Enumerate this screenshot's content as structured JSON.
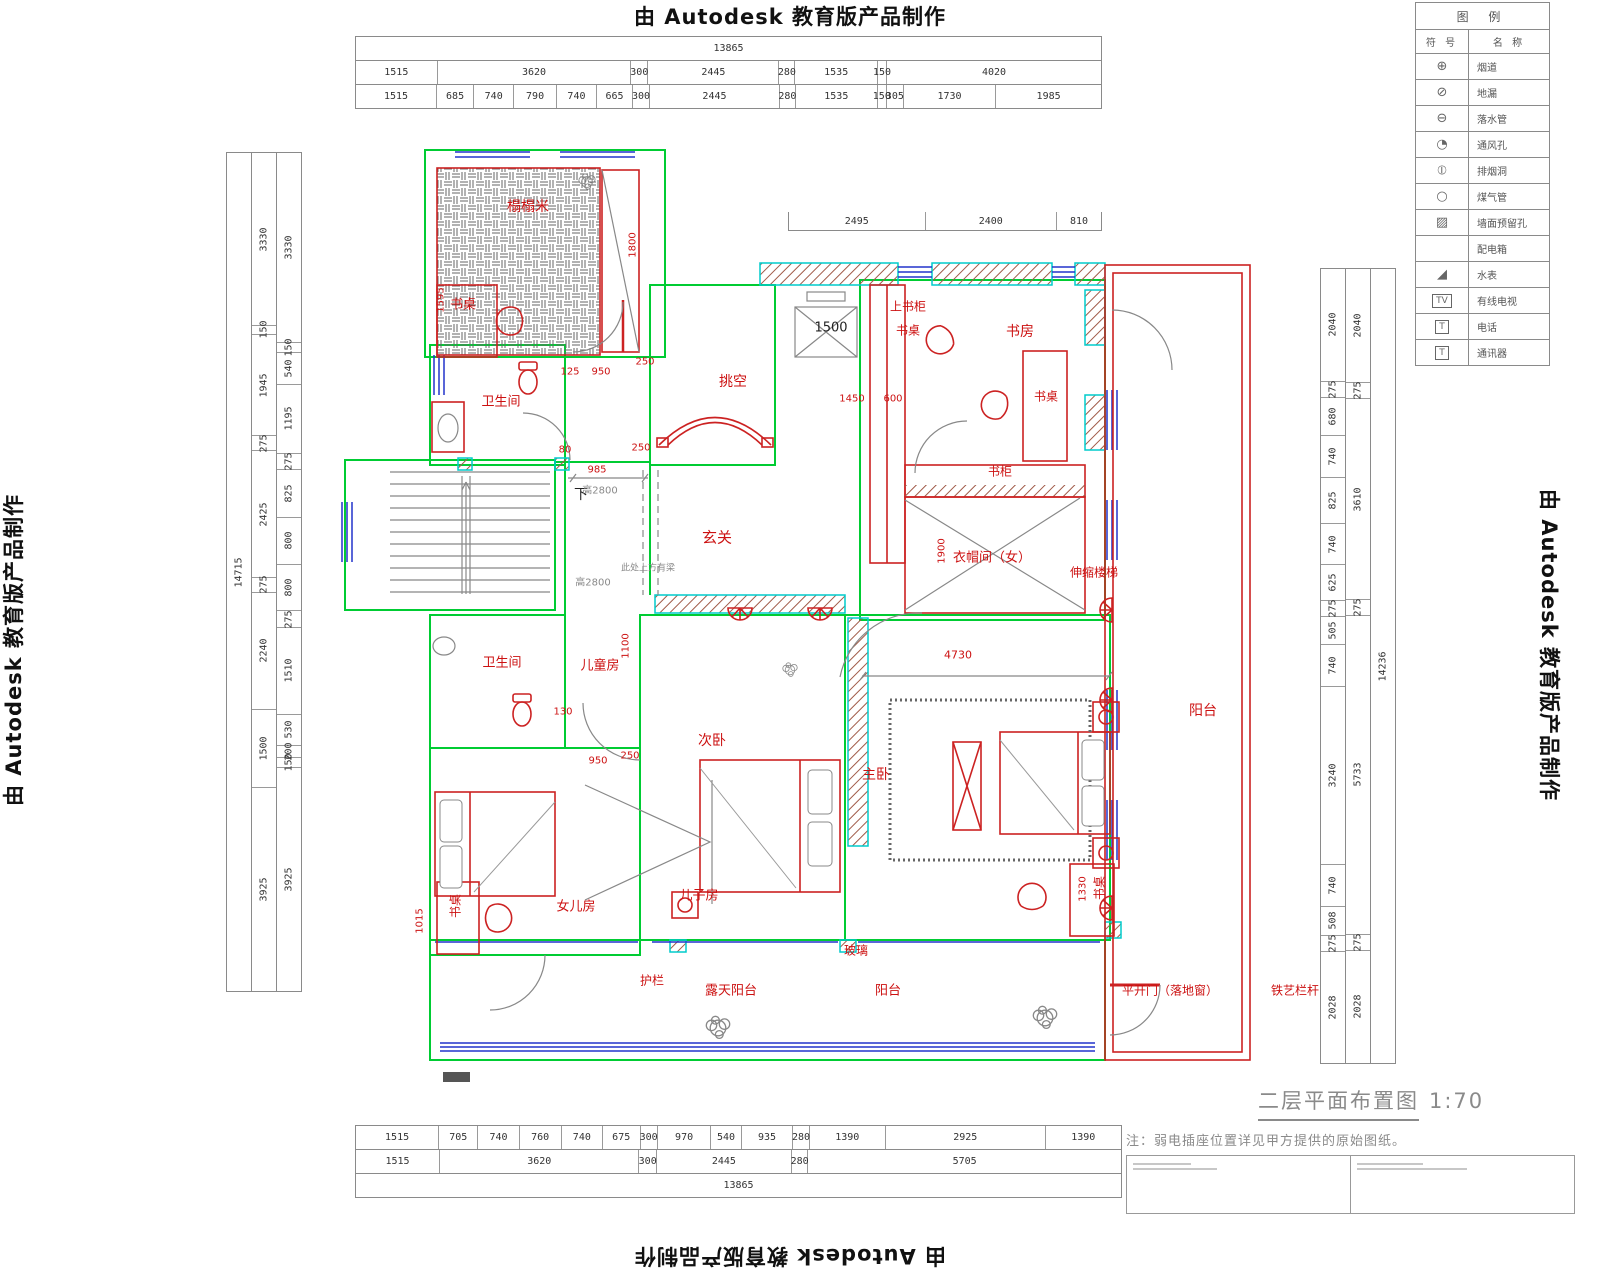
{
  "watermark": {
    "text": "由 Autodesk 教育版产品制作"
  },
  "title": {
    "text": "二层平面布置图",
    "scale": "1:70"
  },
  "note": "注：弱电插座位置详见甲方提供的原始图纸。",
  "legend": {
    "title": "图 例",
    "col_symbol": "符 号",
    "col_name": "名 称",
    "rows": [
      {
        "glyph": "⊕",
        "name": "烟道",
        "boxed": false,
        "icon": "flue-icon"
      },
      {
        "glyph": "⊘",
        "name": "地漏",
        "boxed": false,
        "icon": "floor-drain-icon"
      },
      {
        "glyph": "⊖",
        "name": "落水管",
        "boxed": false,
        "icon": "downpipe-icon"
      },
      {
        "glyph": "◔",
        "name": "通风孔",
        "boxed": false,
        "icon": "vent-hole-icon"
      },
      {
        "glyph": "⦶",
        "name": "排烟洞",
        "boxed": false,
        "icon": "smoke-vent-icon"
      },
      {
        "glyph": "○",
        "name": "煤气管",
        "boxed": false,
        "icon": "gas-pipe-icon"
      },
      {
        "glyph": "▨",
        "name": "墙面预留孔",
        "boxed": false,
        "icon": "wall-reserved-hole-icon"
      },
      {
        "glyph": "",
        "name": "配电箱",
        "boxed": false,
        "icon": "distribution-box-icon"
      },
      {
        "glyph": "◢",
        "name": "水表",
        "boxed": false,
        "icon": "water-meter-icon"
      },
      {
        "glyph": "TV",
        "name": "有线电视",
        "boxed": true,
        "icon": "cable-tv-icon"
      },
      {
        "glyph": "T",
        "name": "电话",
        "boxed": true,
        "icon": "telephone-icon"
      },
      {
        "glyph": "T",
        "name": "通讯器",
        "boxed": true,
        "icon": "intercom-icon"
      }
    ]
  },
  "dims": {
    "top": {
      "total": [
        "13865"
      ],
      "row1": [
        "1515",
        "3620",
        "300",
        "2445",
        "280",
        "1535",
        "150",
        "4020"
      ],
      "row2": [
        "1515",
        "685",
        "740",
        "790",
        "740",
        "665",
        "300",
        "2445",
        "280",
        "1535",
        "150",
        "305",
        "1730",
        "1985"
      ]
    },
    "mid": [
      "2495",
      "2400",
      "810"
    ],
    "bottom": {
      "row1": [
        "1515",
        "705",
        "740",
        "760",
        "740",
        "675",
        "300",
        "970",
        "540",
        "935",
        "280",
        "1390",
        "2925",
        "1390"
      ],
      "row2": [
        "1515",
        "3620",
        "300",
        "2445",
        "280",
        "5705"
      ],
      "total": [
        "13865"
      ]
    },
    "left": {
      "total": [
        "14715"
      ],
      "col_a": [
        "3330",
        "150",
        "1945",
        "275",
        "2425",
        "275",
        "2240",
        "1500",
        "3925"
      ],
      "col_b": [
        "3330",
        "150",
        "540",
        "1195",
        "275",
        "825",
        "800",
        "800",
        "275",
        "1510",
        "530",
        "200",
        "150",
        "3925"
      ]
    },
    "right": {
      "col_a": [
        "2040",
        "275",
        "680",
        "740",
        "825",
        "740",
        "625",
        "275",
        "505",
        "740",
        "3240",
        "740",
        "508",
        "275",
        "2028"
      ],
      "col_b": [
        "2040",
        "275",
        "3610",
        "275",
        "5733",
        "275",
        "2028"
      ],
      "total": [
        "14236"
      ]
    }
  },
  "plan": {
    "labels": [
      {
        "t": "榻榻米",
        "x": 528,
        "y": 206,
        "c": "red",
        "s": 14,
        "n": "room-label-tatami"
      },
      {
        "t": "书桌",
        "x": 463,
        "y": 303,
        "c": "red",
        "s": 13,
        "n": "label-desk"
      },
      {
        "t": "卫生间",
        "x": 501,
        "y": 400,
        "c": "red",
        "s": 13,
        "n": "room-label-bathroom-upper"
      },
      {
        "t": "挑空",
        "x": 733,
        "y": 381,
        "c": "red",
        "s": 14,
        "n": "room-label-void"
      },
      {
        "t": "玄关",
        "x": 717,
        "y": 537,
        "c": "red",
        "s": 15,
        "n": "room-label-foyer"
      },
      {
        "t": "上书柜",
        "x": 908,
        "y": 306,
        "c": "red",
        "s": 12,
        "n": "label-upper-bookcase"
      },
      {
        "t": "书桌",
        "x": 908,
        "y": 330,
        "c": "red",
        "s": 12,
        "n": "label-desk"
      },
      {
        "t": "书房",
        "x": 1020,
        "y": 331,
        "c": "red",
        "s": 14,
        "n": "room-label-study"
      },
      {
        "t": "书桌",
        "x": 1046,
        "y": 396,
        "c": "red",
        "s": 12,
        "n": "label-desk"
      },
      {
        "t": "书柜",
        "x": 1000,
        "y": 471,
        "c": "red",
        "s": 12,
        "n": "label-bookcase"
      },
      {
        "t": "衣帽间（女）",
        "x": 992,
        "y": 556,
        "c": "red",
        "s": 13,
        "n": "room-label-cloakroom"
      },
      {
        "t": "伸缩楼梯",
        "x": 1094,
        "y": 572,
        "c": "red",
        "s": 12,
        "n": "label-retractable-stair"
      },
      {
        "t": "卫生间",
        "x": 502,
        "y": 661,
        "c": "red",
        "s": 13,
        "n": "room-label-bathroom-lower"
      },
      {
        "t": "儿童房",
        "x": 600,
        "y": 664,
        "c": "red",
        "s": 13,
        "n": "room-label-kids-room"
      },
      {
        "t": "次卧",
        "x": 712,
        "y": 740,
        "c": "red",
        "s": 14,
        "n": "room-label-second-bedroom"
      },
      {
        "t": "主卧",
        "x": 876,
        "y": 774,
        "c": "red",
        "s": 14,
        "n": "room-label-master-bedroom"
      },
      {
        "t": "女儿房",
        "x": 576,
        "y": 905,
        "c": "red",
        "s": 13,
        "n": "room-label-daughter-room"
      },
      {
        "t": "书桌",
        "x": 455,
        "y": 906,
        "c": "red",
        "s": 12,
        "r": 90,
        "n": "label-desk"
      },
      {
        "t": "儿子房",
        "x": 699,
        "y": 894,
        "c": "red",
        "s": 13,
        "n": "room-label-son-room"
      },
      {
        "t": "书桌",
        "x": 1099,
        "y": 888,
        "c": "red",
        "s": 12,
        "r": 90,
        "n": "label-desk"
      },
      {
        "t": "阳台",
        "x": 1203,
        "y": 710,
        "c": "red",
        "s": 14,
        "n": "room-label-balcony-right"
      },
      {
        "t": "玻璃",
        "x": 856,
        "y": 950,
        "c": "red",
        "s": 12,
        "n": "label-glass"
      },
      {
        "t": "护栏",
        "x": 652,
        "y": 980,
        "c": "red",
        "s": 12,
        "n": "label-guardrail"
      },
      {
        "t": "露天阳台",
        "x": 731,
        "y": 989,
        "c": "red",
        "s": 13,
        "n": "room-label-open-balcony"
      },
      {
        "t": "阳台",
        "x": 888,
        "y": 989,
        "c": "red",
        "s": 13,
        "n": "room-label-balcony-bottom"
      },
      {
        "t": "平开门（落地窗）",
        "x": 1170,
        "y": 990,
        "c": "red",
        "s": 12,
        "n": "label-casement-door"
      },
      {
        "t": "铁艺栏杆",
        "x": 1295,
        "y": 990,
        "c": "red",
        "s": 12,
        "n": "label-iron-railing"
      },
      {
        "t": "1595",
        "x": 441,
        "y": 300,
        "c": "red",
        "s": 10,
        "r": 90,
        "n": "dim-1595"
      },
      {
        "t": "1800",
        "x": 633,
        "y": 245,
        "c": "red",
        "s": 10,
        "r": 90,
        "n": "dim-1800"
      },
      {
        "t": "125",
        "x": 570,
        "y": 372,
        "c": "red",
        "s": 10,
        "n": "dim-125"
      },
      {
        "t": "950",
        "x": 601,
        "y": 372,
        "c": "red",
        "s": 10,
        "n": "dim-950"
      },
      {
        "t": "250",
        "x": 645,
        "y": 362,
        "c": "red",
        "s": 10,
        "n": "dim-250"
      },
      {
        "t": "250",
        "x": 641,
        "y": 448,
        "c": "red",
        "s": 10,
        "n": "dim-250"
      },
      {
        "t": "80",
        "x": 565,
        "y": 450,
        "c": "red",
        "s": 10,
        "n": "dim-80"
      },
      {
        "t": "985",
        "x": 597,
        "y": 470,
        "c": "red",
        "s": 10,
        "n": "dim-985"
      },
      {
        "t": "950",
        "x": 598,
        "y": 761,
        "c": "red",
        "s": 10,
        "n": "dim-950"
      },
      {
        "t": "250",
        "x": 630,
        "y": 756,
        "c": "red",
        "s": 10,
        "n": "dim-250"
      },
      {
        "t": "130",
        "x": 563,
        "y": 712,
        "c": "red",
        "s": 10,
        "n": "dim-130"
      },
      {
        "t": "1100",
        "x": 626,
        "y": 646,
        "c": "red",
        "s": 10,
        "r": 90,
        "n": "dim-1100"
      },
      {
        "t": "1450",
        "x": 852,
        "y": 399,
        "c": "red",
        "s": 10,
        "n": "dim-1450"
      },
      {
        "t": "600",
        "x": 893,
        "y": 399,
        "c": "red",
        "s": 10,
        "n": "dim-600"
      },
      {
        "t": "1900",
        "x": 942,
        "y": 551,
        "c": "red",
        "s": 10,
        "r": 90,
        "n": "dim-1900"
      },
      {
        "t": "4730",
        "x": 958,
        "y": 655,
        "c": "red",
        "s": 11,
        "n": "dim-4730"
      },
      {
        "t": "1015",
        "x": 420,
        "y": 921,
        "c": "red",
        "s": 10,
        "r": 90,
        "n": "dim-1015"
      },
      {
        "t": "1330",
        "x": 1083,
        "y": 889,
        "c": "red",
        "s": 10,
        "r": 90,
        "n": "dim-1330"
      },
      {
        "t": "1500",
        "x": 831,
        "y": 328,
        "c": "blk",
        "s": 13,
        "n": "dim-1500-elevator"
      },
      {
        "t": "下",
        "x": 581,
        "y": 494,
        "c": "blk",
        "s": 14,
        "n": "label-stairs-down"
      },
      {
        "t": "高2800",
        "x": 600,
        "y": 489,
        "c": "gray",
        "s": 10,
        "n": "label-height-2800"
      },
      {
        "t": "高2800",
        "x": 593,
        "y": 581,
        "c": "gray",
        "s": 10,
        "n": "label-height-2800"
      },
      {
        "t": "此处上方有梁",
        "x": 648,
        "y": 567,
        "c": "gray",
        "s": 9,
        "n": "label-beam-note"
      }
    ]
  }
}
